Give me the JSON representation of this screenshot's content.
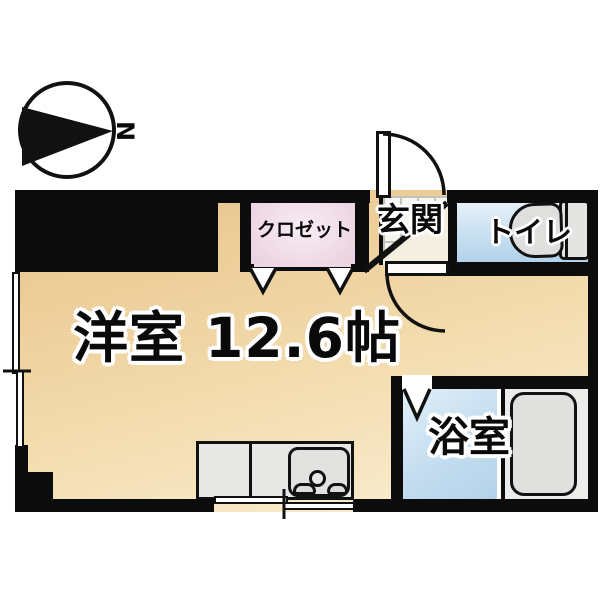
{
  "page": {
    "type": "japanese-apartment-floorplan"
  },
  "compass": {
    "north_label": "N"
  },
  "rooms": {
    "main_room": {
      "label": "洋室 12.6帖"
    },
    "closet": {
      "label": "クロゼット"
    },
    "entrance": {
      "label": "玄関"
    },
    "toilet": {
      "label": "トイレ"
    },
    "bathroom": {
      "label": "浴室"
    }
  },
  "colors": {
    "wall": "#0c0c0c",
    "main_room_floor": "#f3dcae",
    "closet_floor": "#ecd3e1",
    "toilet_floor": "#cfe4f3",
    "bathroom_floor": "#c6def0",
    "entrance_step": "#f4f0e1",
    "fixture_gray": "#e3e3e1"
  }
}
